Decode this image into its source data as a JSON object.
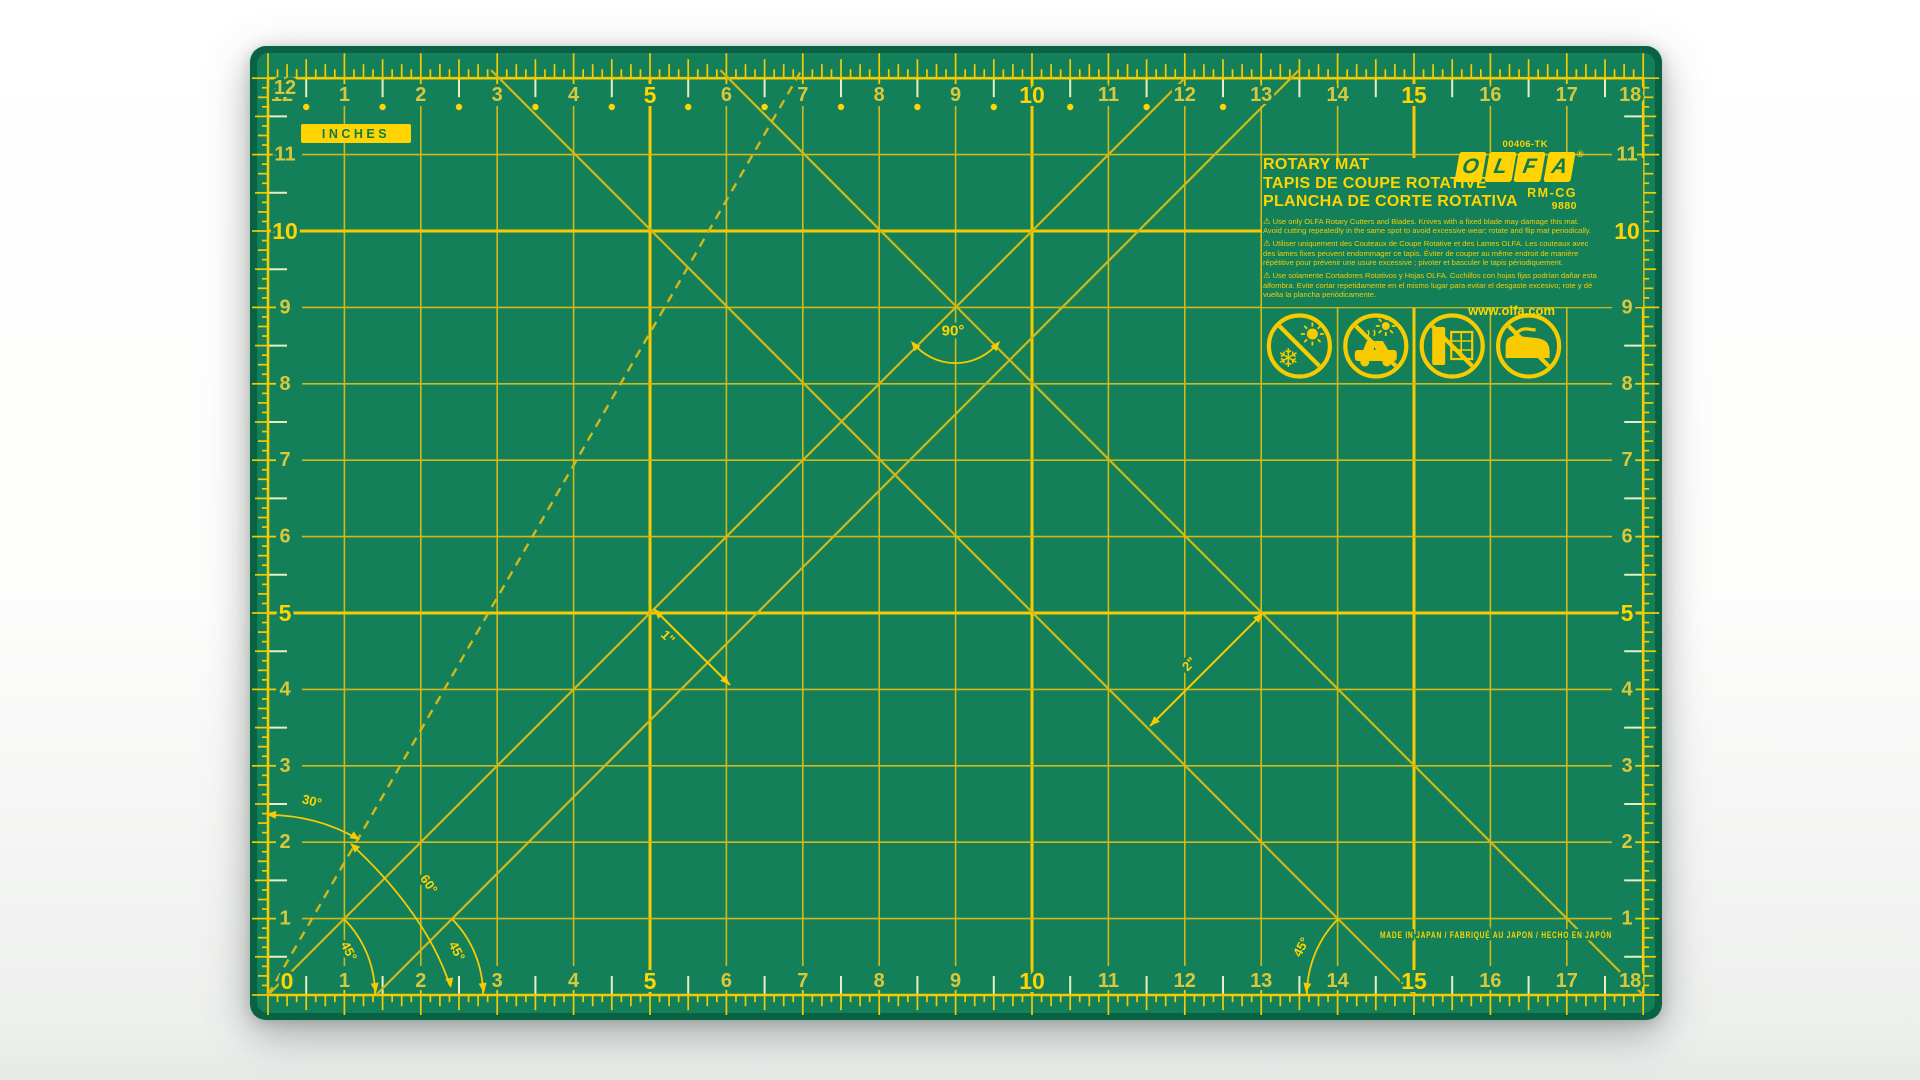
{
  "mat": {
    "units_label": "INCHES",
    "sku": "00406-TK",
    "brand_letters": [
      "O",
      "L",
      "F",
      "A"
    ],
    "registered": "®",
    "model": "RM-CG",
    "model_number": "9880",
    "website": "www.olfa.com",
    "made_in": "MADE IN JAPAN / FABRIQUÉ AU JAPON / HECHO EN JAPÓN",
    "titles": [
      "ROTARY MAT",
      "TAPIS DE COUPE ROTATIVE",
      "PLANCHA DE CORTE ROTATIVA"
    ],
    "warning_symbol": "⚠",
    "warnings": [
      "Use only OLFA Rotary Cutters and Blades. Knives with a fixed blade may damage this mat. Avoid cutting repeatedly in the same spot to avoid excessive wear; rotate and flip mat periodically.",
      "Utiliser uniquement des Couteaux de Coupe Rotative et des Lames OLFA. Les couteaux avec des lames fixes peuvent endommager ce tapis. Éviter de couper au même endroit de manière répétitive pour prévenir une usure excessive ; pivoter et basculer le tapis périodiquement.",
      "Use solamente Cortadores Rotativos y Hojas OLFA. Cuchillos con hojas fijas podrían dañar esta alfombra. Evite cortar repetidamente en el mismo lugar para evitar el desgaste excesivo; rote y dé vuelta la plancha periódicamente."
    ],
    "icon_names": [
      "no-extreme-temperatures-icon",
      "no-hot-car-icon",
      "no-window-sunlight-icon",
      "no-ironing-icon"
    ],
    "glyphs": {
      "snowflake": "❄"
    }
  },
  "scales": {
    "top": [
      "12",
      "1",
      "2",
      "3",
      "4",
      "5",
      "6",
      "7",
      "8",
      "9",
      "10",
      "11",
      "12",
      "13",
      "14",
      "15",
      "16",
      "17",
      "18"
    ],
    "bottom": [
      "0",
      "1",
      "2",
      "3",
      "4",
      "5",
      "6",
      "7",
      "8",
      "9",
      "10",
      "11",
      "12",
      "13",
      "14",
      "15",
      "16",
      "17",
      "18"
    ],
    "left": [
      "12",
      "11",
      "10",
      "9",
      "8",
      "7",
      "6",
      "5",
      "4",
      "3",
      "2",
      "1"
    ],
    "right": [
      "11",
      "10",
      "9",
      "8",
      "7",
      "6",
      "5",
      "4",
      "3",
      "2",
      "1"
    ],
    "bold_multiple": 5
  },
  "annotations": {
    "angle_90": "90°",
    "angle_30": "30°",
    "angle_60": "60°",
    "angle_45_a": "45°",
    "angle_45_b": "45°",
    "angle_45_c": "45°",
    "measure_1in": "1\"",
    "measure_2in": "2\""
  },
  "colors": {
    "mat_green": "#13805A",
    "mat_edge": "#0A6245",
    "line_yellow": "#D2B818",
    "bright_yellow": "#F7CB00",
    "number_yellow": "#FFD400",
    "number_regular": "#D9C73C",
    "pale_tick": "#E6EFC2",
    "logo_green": "#0E7A50",
    "background": "#FFFFFF"
  }
}
